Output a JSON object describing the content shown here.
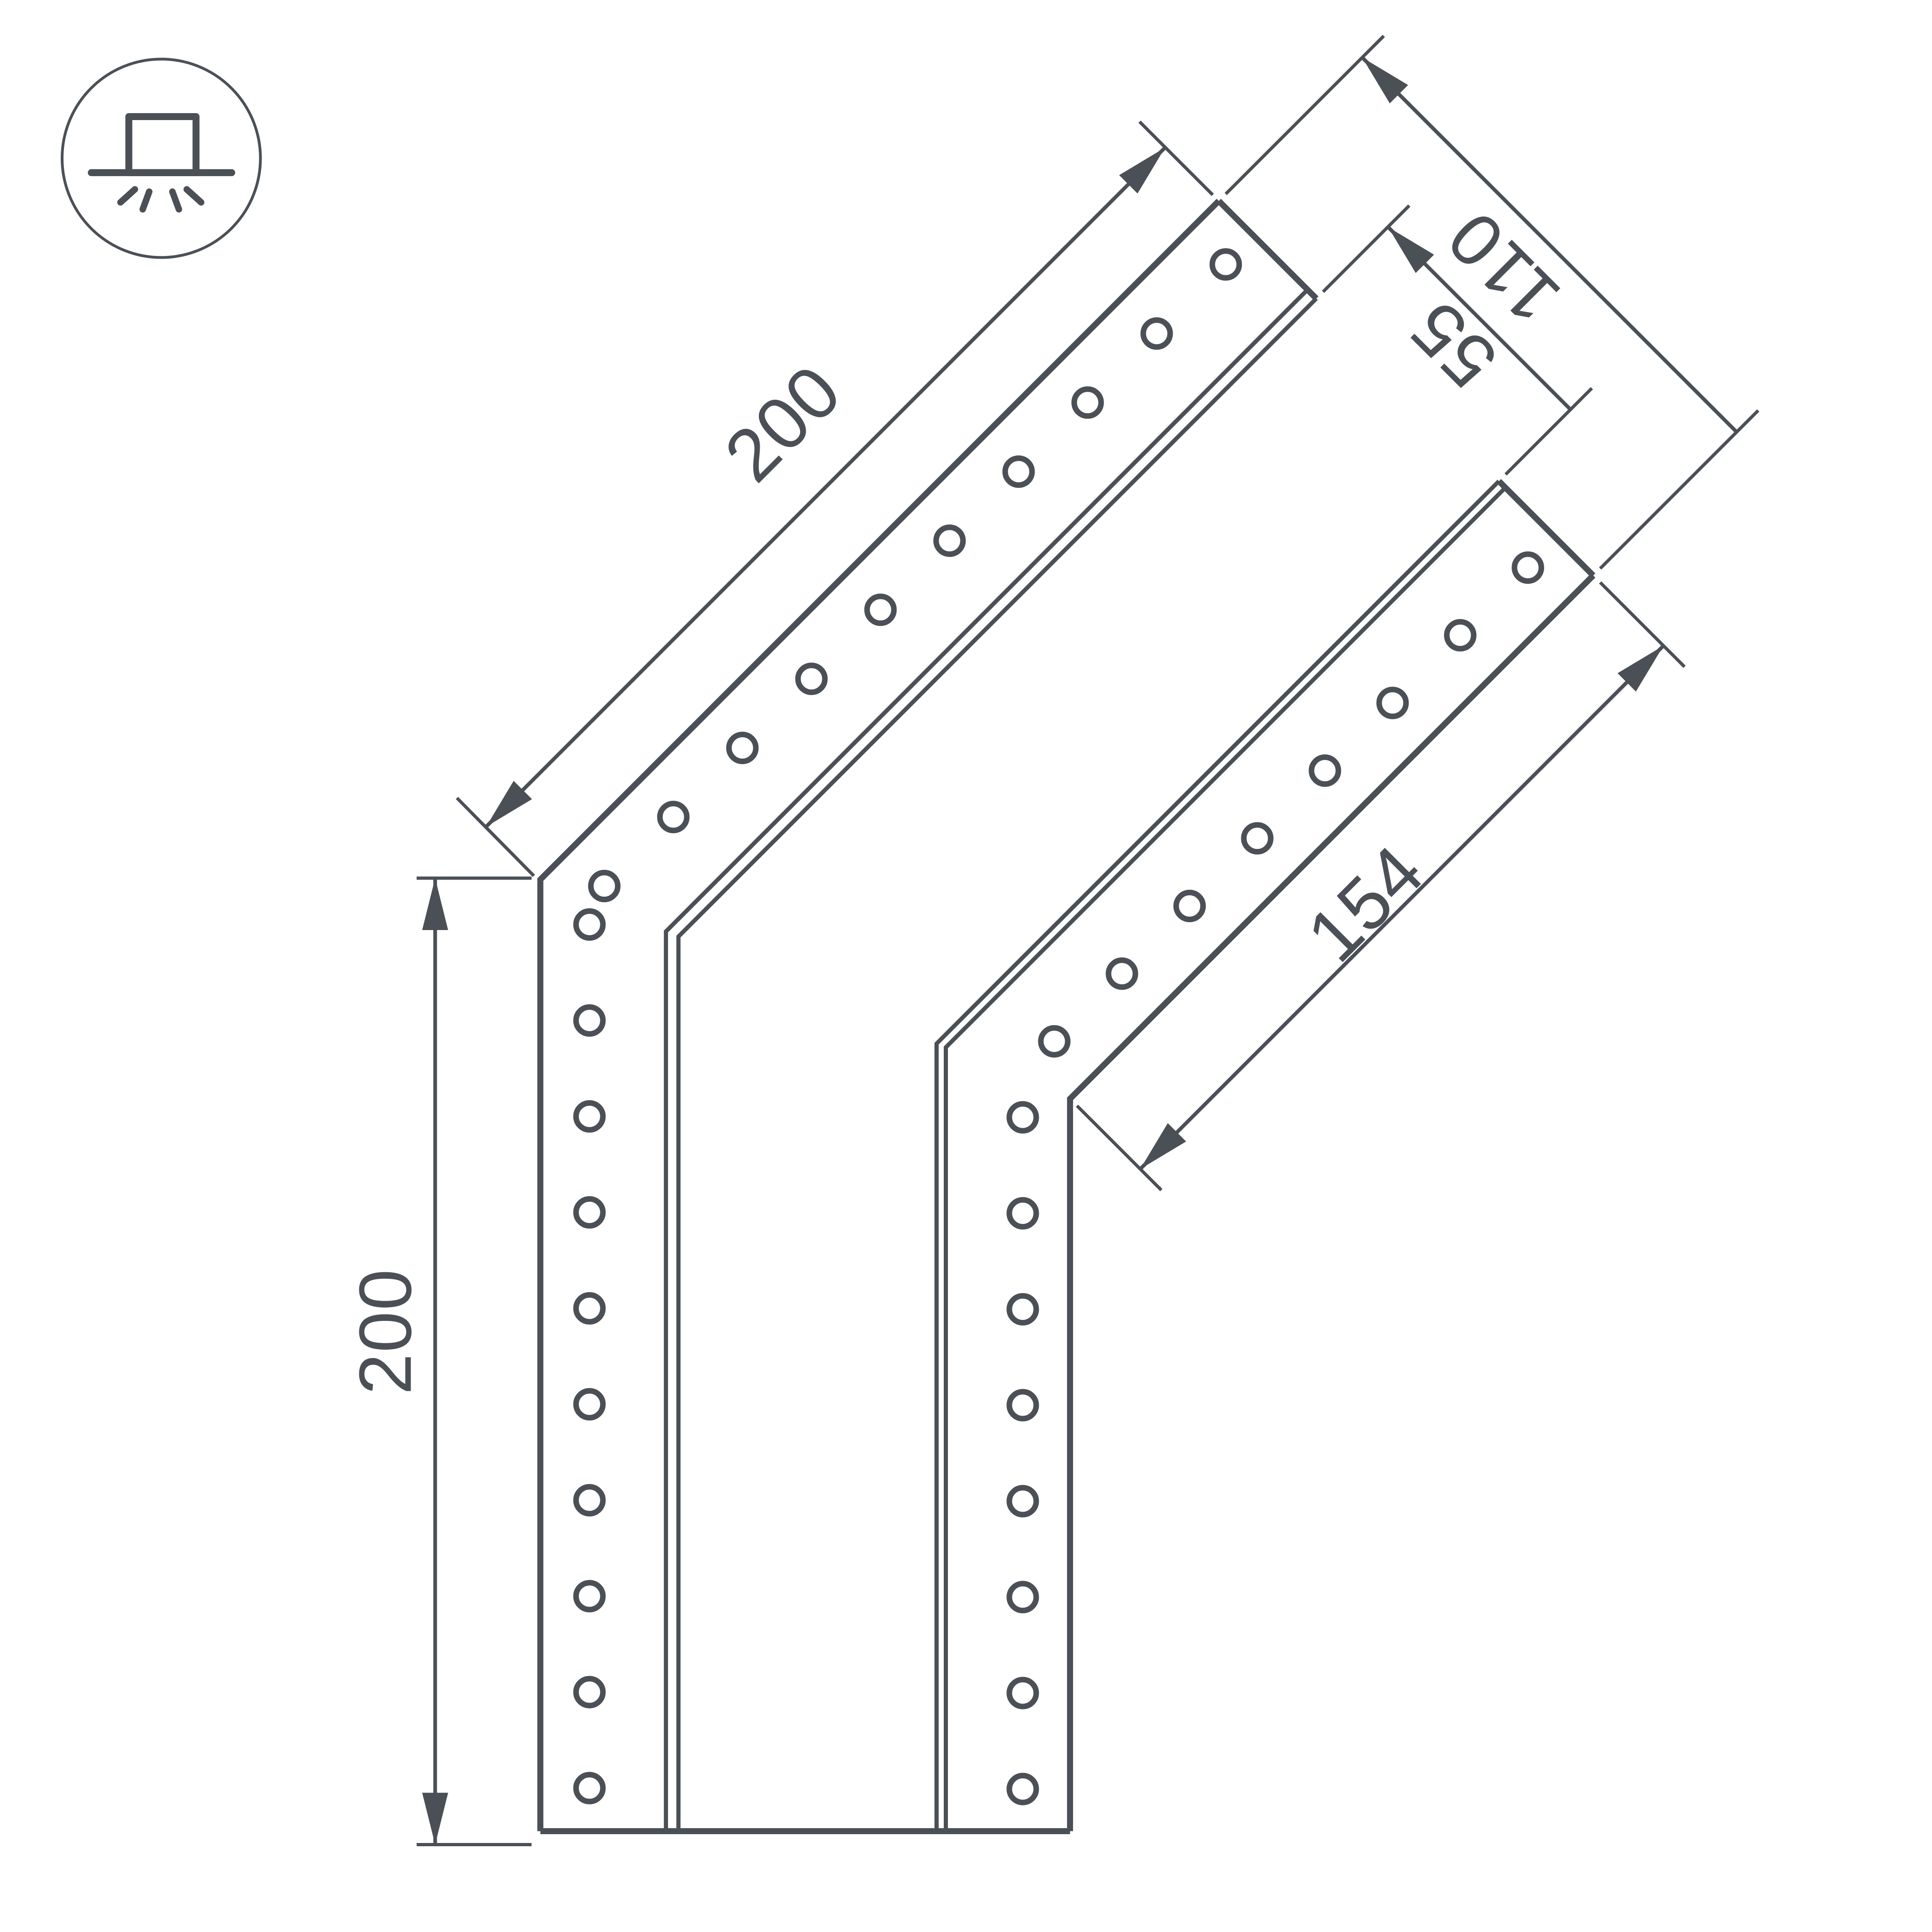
{
  "drawing": {
    "kind": "technical-dimension-drawing",
    "subject": "135-degree corner connector profile with mounting holes",
    "background_color": "#ffffff",
    "line_color": "#4a5056",
    "dimension_labels": {
      "vertical_leg": "200",
      "diagonal_leg": "200",
      "inner_diagonal_leg": "154",
      "end_total_width": "110",
      "end_channel_width": "55"
    },
    "icon": {
      "name": "surface-mounted-luminaire-icon",
      "description": "circle badge with square fixture on ceiling line and light rays shining down"
    }
  }
}
